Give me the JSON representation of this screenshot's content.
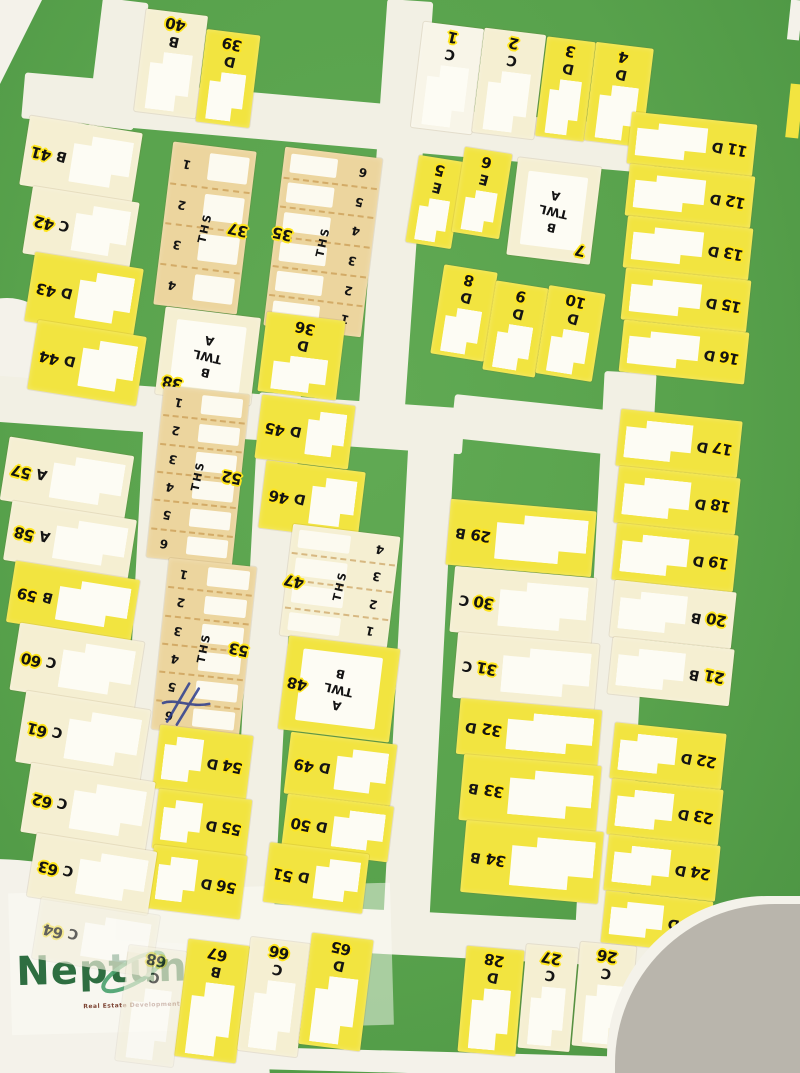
{
  "watermark": {
    "brand": "Neptune",
    "tagline": "Real Estate Development & Services"
  },
  "colors": {
    "green": "#58a24c",
    "green_hi": "#61aa54",
    "green_lo": "#4b9342",
    "road": "#f2f0e4",
    "paper": "#f4f2ea",
    "gray": "#b9b5ac",
    "yellow": "#f2e440",
    "cream": "#f5efd2",
    "tan": "#ecd59e",
    "white_plot": "#f8f5e8",
    "halo": "#ffe61e",
    "ink": "#141414",
    "logo_green": "#2e6e41",
    "tagline": "#7c4433"
  },
  "map": {
    "roads": [
      {
        "x": 95,
        "y": 0,
        "w": 46,
        "h": 128,
        "r": 7
      },
      {
        "x": 22,
        "y": 100,
        "w": 635,
        "h": 46,
        "r": 5
      },
      {
        "x": 372,
        "y": 0,
        "w": 46,
        "h": 440,
        "r": 4
      },
      {
        "x": -6,
        "y": 392,
        "w": 470,
        "h": 46,
        "r": 4
      },
      {
        "x": 452,
        "y": 408,
        "w": 268,
        "h": 44,
        "r": 6
      },
      {
        "x": 590,
        "y": 372,
        "w": 52,
        "h": 558,
        "r": 3
      },
      {
        "x": 131,
        "y": 398,
        "w": 38,
        "h": 528,
        "r": 3
      },
      {
        "x": 245,
        "y": 393,
        "w": 42,
        "h": 542,
        "r": 3
      },
      {
        "x": 396,
        "y": 430,
        "w": 46,
        "h": 500,
        "r": 3
      },
      {
        "x": 116,
        "y": 912,
        "w": 614,
        "h": 44,
        "r": 3
      }
    ],
    "plots": [
      {
        "n": "40",
        "t": "B",
        "k": "v",
        "f": "c",
        "x": 140,
        "y": 12,
        "w": 62,
        "h": 103,
        "r": 7
      },
      {
        "n": "39",
        "t": "D",
        "k": "v",
        "f": "y",
        "x": 201,
        "y": 32,
        "w": 54,
        "h": 93,
        "r": 7
      },
      {
        "n": "1",
        "t": "C",
        "k": "v",
        "f": "w",
        "x": 417,
        "y": 25,
        "w": 61,
        "h": 106,
        "r": 7
      },
      {
        "n": "2",
        "t": "C",
        "k": "v",
        "f": "c",
        "x": 478,
        "y": 31,
        "w": 62,
        "h": 105,
        "r": 7
      },
      {
        "n": "3",
        "t": "D",
        "k": "v",
        "f": "y",
        "x": 541,
        "y": 39,
        "w": 49,
        "h": 100,
        "r": 7
      },
      {
        "n": "4",
        "t": "D",
        "k": "v",
        "f": "y",
        "x": 590,
        "y": 45,
        "w": 58,
        "h": 99,
        "r": 7
      },
      {
        "n": "5",
        "t": "E",
        "k": "v",
        "f": "y",
        "x": 412,
        "y": 158,
        "w": 46,
        "h": 88,
        "r": 9
      },
      {
        "n": "6",
        "t": "E",
        "k": "v",
        "f": "y",
        "x": 458,
        "y": 150,
        "w": 48,
        "h": 86,
        "r": 9
      },
      {
        "n": "7",
        "t": "TWL",
        "k": "twl",
        "f": "c",
        "x": 512,
        "y": 162,
        "w": 84,
        "h": 98,
        "r": 7,
        "lines": [
          "A",
          "TWL",
          "B"
        ],
        "np": "br"
      },
      {
        "n": "8",
        "t": "D",
        "k": "v",
        "f": "y",
        "x": 437,
        "y": 268,
        "w": 54,
        "h": 90,
        "r": 9
      },
      {
        "n": "9",
        "t": "D",
        "k": "v",
        "f": "y",
        "x": 489,
        "y": 284,
        "w": 53,
        "h": 90,
        "r": 9
      },
      {
        "n": "10",
        "t": "D",
        "k": "v",
        "f": "y",
        "x": 542,
        "y": 289,
        "w": 57,
        "h": 89,
        "r": 9
      },
      {
        "n": "41",
        "t": "B",
        "k": "hr",
        "f": "c",
        "x": 24,
        "y": 124,
        "w": 114,
        "h": 70,
        "r": 9
      },
      {
        "n": "42",
        "t": "C",
        "k": "hr",
        "f": "c",
        "x": 27,
        "y": 194,
        "w": 108,
        "h": 68,
        "r": 9
      },
      {
        "n": "43",
        "t": "D",
        "k": "hr",
        "f": "y",
        "x": 29,
        "y": 260,
        "w": 110,
        "h": 70,
        "r": 9
      },
      {
        "n": "44",
        "t": "D",
        "k": "hr",
        "f": "y",
        "x": 32,
        "y": 328,
        "w": 110,
        "h": 70,
        "r": 9
      },
      {
        "n": "37",
        "t": "THS",
        "k": "ths",
        "f": "t",
        "x": 163,
        "y": 146,
        "w": 84,
        "h": 164,
        "r": 7,
        "units": [
          "1",
          "2",
          "3",
          "4"
        ],
        "ns": "r"
      },
      {
        "n": "35",
        "t": "THS",
        "k": "ths",
        "f": "t",
        "x": 274,
        "y": 152,
        "w": 98,
        "h": 180,
        "r": 7,
        "units": [
          "6",
          "5",
          "4",
          "3",
          "2",
          "1"
        ],
        "ns": "l"
      },
      {
        "n": "38",
        "t": "TWL",
        "k": "twl",
        "f": "c",
        "x": 160,
        "y": 312,
        "w": 96,
        "h": 88,
        "r": 7,
        "lines": [
          "A",
          "TWL",
          "B"
        ],
        "np": "bl"
      },
      {
        "n": "36",
        "t": "D",
        "k": "v",
        "f": "y",
        "x": 262,
        "y": 316,
        "w": 79,
        "h": 80,
        "r": 7
      },
      {
        "n": "45",
        "t": "D",
        "k": "hr",
        "f": "y",
        "x": 258,
        "y": 400,
        "w": 94,
        "h": 64,
        "r": 7
      },
      {
        "n": "46",
        "t": "D",
        "k": "hr",
        "f": "y",
        "x": 262,
        "y": 466,
        "w": 100,
        "h": 68,
        "r": 7
      },
      {
        "n": "47",
        "t": "THS",
        "k": "ths",
        "f": "c",
        "x": 286,
        "y": 530,
        "w": 108,
        "h": 112,
        "r": 7,
        "units": [
          "4",
          "3",
          "2",
          "1"
        ],
        "ns": "l"
      },
      {
        "n": "48",
        "t": "TWL",
        "k": "twl",
        "f": "y",
        "x": 283,
        "y": 642,
        "w": 112,
        "h": 94,
        "r": 7,
        "lines": [
          "B",
          "TWL",
          "A"
        ],
        "np": "l"
      },
      {
        "n": "49",
        "t": "D",
        "k": "hr",
        "f": "y",
        "x": 287,
        "y": 738,
        "w": 107,
        "h": 62,
        "r": 7
      },
      {
        "n": "50",
        "t": "D",
        "k": "hr",
        "f": "y",
        "x": 284,
        "y": 800,
        "w": 107,
        "h": 56,
        "r": 7
      },
      {
        "n": "51",
        "t": "D",
        "k": "hr",
        "f": "y",
        "x": 266,
        "y": 848,
        "w": 100,
        "h": 60,
        "r": 7
      },
      {
        "n": "52",
        "t": "THS",
        "k": "ths",
        "f": "t",
        "x": 155,
        "y": 390,
        "w": 86,
        "h": 172,
        "r": 6,
        "units": [
          "1",
          "2",
          "3",
          "4",
          "5",
          "6"
        ],
        "ns": "r"
      },
      {
        "n": "53",
        "t": "THS",
        "k": "ths",
        "f": "t",
        "x": 160,
        "y": 562,
        "w": 88,
        "h": 172,
        "r": 6,
        "units": [
          "1",
          "2",
          "3",
          "4",
          "5",
          "6"
        ],
        "ns": "r",
        "scribble": true
      },
      {
        "n": "54",
        "t": "D",
        "k": "h",
        "f": "y",
        "x": 156,
        "y": 730,
        "w": 94,
        "h": 64,
        "r": 7
      },
      {
        "n": "55",
        "t": "D",
        "k": "h",
        "f": "y",
        "x": 155,
        "y": 794,
        "w": 94,
        "h": 60,
        "r": 7
      },
      {
        "n": "56",
        "t": "D",
        "k": "h",
        "f": "y",
        "x": 150,
        "y": 850,
        "w": 94,
        "h": 64,
        "r": 7
      },
      {
        "n": "57",
        "t": "A",
        "k": "hr",
        "f": "c",
        "x": 4,
        "y": 446,
        "w": 126,
        "h": 64,
        "r": 9
      },
      {
        "n": "58",
        "t": "A",
        "k": "hr",
        "f": "c",
        "x": 7,
        "y": 510,
        "w": 126,
        "h": 60,
        "r": 9
      },
      {
        "n": "59",
        "t": "B",
        "k": "hr",
        "f": "y",
        "x": 10,
        "y": 570,
        "w": 126,
        "h": 62,
        "r": 9
      },
      {
        "n": "60",
        "t": "C",
        "k": "hr",
        "f": "c",
        "x": 14,
        "y": 632,
        "w": 126,
        "h": 68,
        "r": 9
      },
      {
        "n": "61",
        "t": "C",
        "k": "hr",
        "f": "c",
        "x": 20,
        "y": 700,
        "w": 126,
        "h": 72,
        "r": 9
      },
      {
        "n": "62",
        "t": "C",
        "k": "hr",
        "f": "c",
        "x": 25,
        "y": 772,
        "w": 126,
        "h": 70,
        "r": 9
      },
      {
        "n": "63",
        "t": "C",
        "k": "hr",
        "f": "c",
        "x": 31,
        "y": 842,
        "w": 122,
        "h": 64,
        "r": 9
      },
      {
        "n": "64",
        "t": "C",
        "k": "hr",
        "f": "c",
        "x": 36,
        "y": 906,
        "w": 120,
        "h": 62,
        "r": 9,
        "faded": true
      },
      {
        "n": "29",
        "t": "B",
        "k": "hl",
        "f": "y",
        "x": 448,
        "y": 505,
        "w": 146,
        "h": 66,
        "r": 5
      },
      {
        "n": "30",
        "t": "C",
        "k": "hl",
        "f": "c",
        "x": 452,
        "y": 572,
        "w": 142,
        "h": 66,
        "r": 5
      },
      {
        "n": "31",
        "t": "C",
        "k": "hl",
        "f": "c",
        "x": 455,
        "y": 638,
        "w": 142,
        "h": 66,
        "r": 5
      },
      {
        "n": "32",
        "t": "D",
        "k": "hl",
        "f": "y",
        "x": 458,
        "y": 704,
        "w": 142,
        "h": 56,
        "r": 5
      },
      {
        "n": "33",
        "t": "B",
        "k": "hl",
        "f": "y",
        "x": 461,
        "y": 760,
        "w": 138,
        "h": 66,
        "r": 5
      },
      {
        "n": "34",
        "t": "B",
        "k": "hl",
        "f": "y",
        "x": 463,
        "y": 826,
        "w": 138,
        "h": 72,
        "r": 5
      },
      {
        "n": "11",
        "t": "D",
        "k": "h",
        "f": "y",
        "x": 629,
        "y": 118,
        "w": 126,
        "h": 52,
        "r": 6
      },
      {
        "n": "12",
        "t": "D",
        "k": "h",
        "f": "y",
        "x": 627,
        "y": 170,
        "w": 126,
        "h": 52,
        "r": 6
      },
      {
        "n": "13",
        "t": "D",
        "k": "h",
        "f": "y",
        "x": 625,
        "y": 222,
        "w": 126,
        "h": 52,
        "r": 6
      },
      {
        "n": "15",
        "t": "D",
        "k": "h",
        "f": "y",
        "x": 623,
        "y": 274,
        "w": 126,
        "h": 52,
        "r": 6
      },
      {
        "n": "16",
        "t": "D",
        "k": "h",
        "f": "y",
        "x": 621,
        "y": 326,
        "w": 126,
        "h": 52,
        "r": 6
      },
      {
        "n": "17",
        "t": "D",
        "k": "h",
        "f": "y",
        "x": 618,
        "y": 415,
        "w": 122,
        "h": 57,
        "r": 6
      },
      {
        "n": "18",
        "t": "D",
        "k": "h",
        "f": "y",
        "x": 616,
        "y": 472,
        "w": 122,
        "h": 57,
        "r": 6
      },
      {
        "n": "19",
        "t": "D",
        "k": "h",
        "f": "y",
        "x": 614,
        "y": 529,
        "w": 122,
        "h": 57,
        "r": 6
      },
      {
        "n": "20",
        "t": "B",
        "k": "h",
        "f": "c",
        "x": 612,
        "y": 586,
        "w": 122,
        "h": 57,
        "r": 6
      },
      {
        "n": "21",
        "t": "B",
        "k": "h",
        "f": "c",
        "x": 610,
        "y": 643,
        "w": 122,
        "h": 57,
        "r": 6
      },
      {
        "n": "22",
        "t": "D",
        "k": "h",
        "f": "y",
        "x": 612,
        "y": 728,
        "w": 112,
        "h": 56,
        "r": 6
      },
      {
        "n": "23",
        "t": "D",
        "k": "h",
        "f": "y",
        "x": 609,
        "y": 784,
        "w": 112,
        "h": 56,
        "r": 6
      },
      {
        "n": "24",
        "t": "D",
        "k": "h",
        "f": "y",
        "x": 606,
        "y": 840,
        "w": 112,
        "h": 56,
        "r": 6
      },
      {
        "n": "25",
        "t": "D",
        "k": "h",
        "f": "y",
        "x": 603,
        "y": 896,
        "w": 108,
        "h": 52,
        "r": 6
      },
      {
        "n": "68",
        "t": "C",
        "k": "v",
        "f": "c",
        "x": 122,
        "y": 948,
        "w": 58,
        "h": 116,
        "r": 7,
        "faded": true
      },
      {
        "n": "67",
        "t": "B",
        "k": "v",
        "f": "y",
        "x": 181,
        "y": 942,
        "w": 62,
        "h": 118,
        "r": 7
      },
      {
        "n": "66",
        "t": "C",
        "k": "v",
        "f": "c",
        "x": 244,
        "y": 940,
        "w": 60,
        "h": 114,
        "r": 7
      },
      {
        "n": "65",
        "t": "D",
        "k": "v",
        "f": "y",
        "x": 305,
        "y": 936,
        "w": 62,
        "h": 112,
        "r": 7
      },
      {
        "n": "28",
        "t": "D",
        "k": "v",
        "f": "y",
        "x": 462,
        "y": 948,
        "w": 58,
        "h": 106,
        "r": 5
      },
      {
        "n": "27",
        "t": "C",
        "k": "v",
        "f": "c",
        "x": 522,
        "y": 946,
        "w": 52,
        "h": 104,
        "r": 5
      },
      {
        "n": "26",
        "t": "C",
        "k": "v",
        "f": "c",
        "x": 576,
        "y": 944,
        "w": 56,
        "h": 104,
        "r": 5
      }
    ]
  }
}
